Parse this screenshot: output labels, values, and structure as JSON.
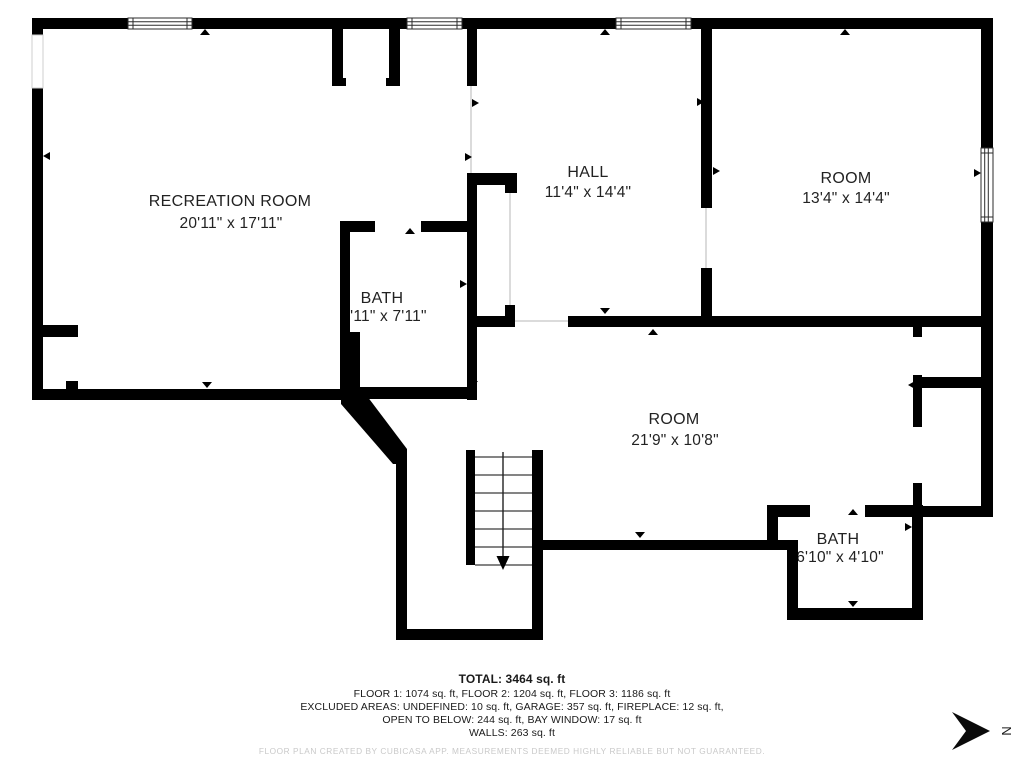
{
  "rooms": [
    {
      "name": "RECREATION ROOM",
      "dims": "20'11\" x 17'11\""
    },
    {
      "name": "HALL",
      "dims": "11'4\" x 14'4\""
    },
    {
      "name": "ROOM",
      "dims": "13'4\" x 14'4\""
    },
    {
      "name": "BATH",
      "dims": "5'11\" x 7'11\""
    },
    {
      "name": "ROOM",
      "dims": "21'9\" x 10'8\""
    },
    {
      "name": "BATH",
      "dims": "6'10\" x 4'10\""
    }
  ],
  "summary": {
    "total": "TOTAL: 3464 sq. ft",
    "floors": "FLOOR 1: 1074 sq. ft, FLOOR 2: 1204 sq. ft, FLOOR 3: 1186 sq. ft",
    "excluded1": "EXCLUDED AREAS: UNDEFINED: 10 sq. ft, GARAGE: 357 sq. ft, FIREPLACE: 12 sq. ft,",
    "excluded2": "OPEN TO BELOW: 244 sq. ft, BAY WINDOW: 17 sq. ft",
    "walls": "WALLS: 263 sq. ft"
  },
  "disclaimer": "FLOOR PLAN CREATED BY CUBICASA APP. MEASUREMENTS DEEMED HIGHLY RELIABLE BUT NOT GUARANTEED.",
  "compass": {
    "label": "N"
  },
  "colors": {
    "wall": "#000000",
    "text": "#222222",
    "disclaimer": "#c9c9c9"
  }
}
